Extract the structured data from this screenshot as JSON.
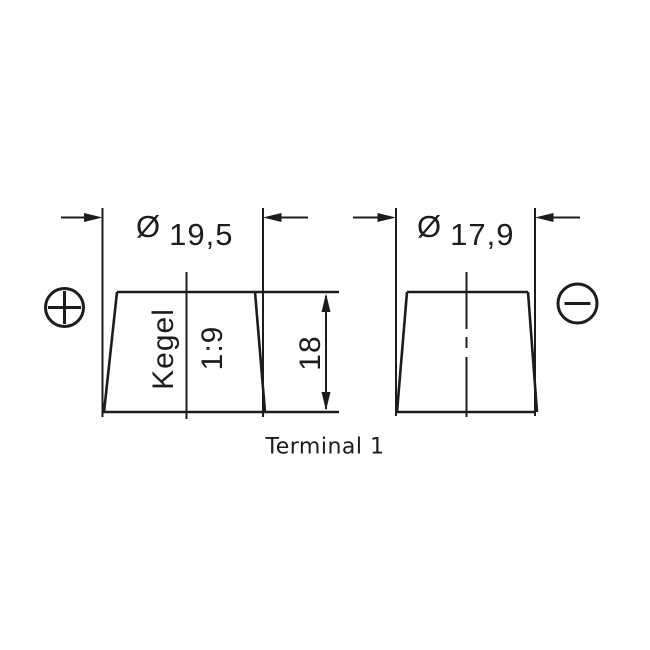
{
  "drawing": {
    "caption": "Terminal 1",
    "colors": {
      "ink": "#1c1c1c",
      "background": "#ffffff"
    },
    "terminals": [
      {
        "id": "positive",
        "polarity_icon": "plus-circle-icon",
        "diameter_symbol": "Ø",
        "diameter_value": "19,5",
        "taper_label": "Kegel",
        "taper_ratio": "1:9",
        "height_value": "18"
      },
      {
        "id": "negative",
        "polarity_icon": "minus-circle-icon",
        "diameter_symbol": "Ø",
        "diameter_value": "17,9"
      }
    ]
  }
}
